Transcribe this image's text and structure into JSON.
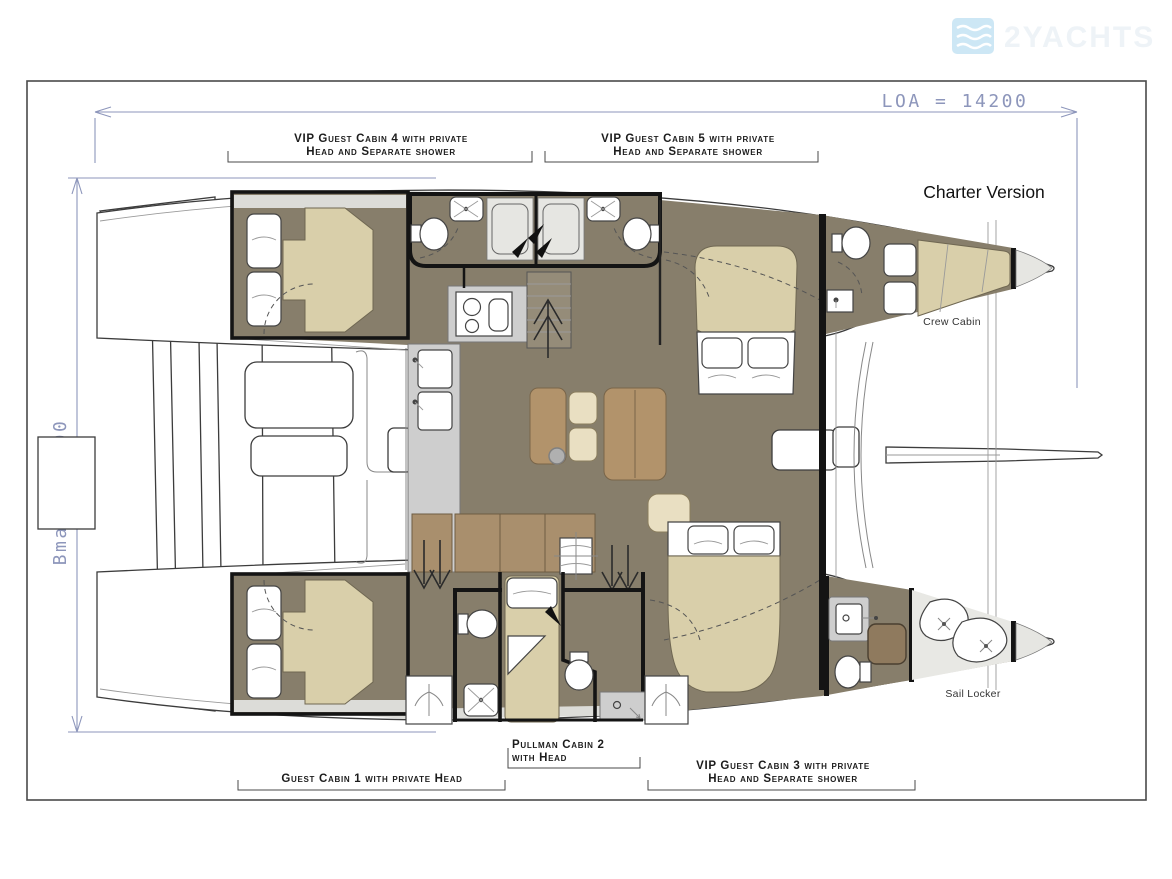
{
  "figure": {
    "kind": "catamaran-deck-plan",
    "version_note": "Charter Version"
  },
  "watermark": {
    "text": "2YACHTS",
    "icon": "waves-logo-icon",
    "icon_color": "#cde7f5"
  },
  "dims": {
    "loa": "LOA = 14200",
    "bmax": "Bmax = 8000",
    "color": "#8d96bb"
  },
  "annotations": {
    "charter": "Charter Version",
    "crew": "Crew Cabin",
    "sail": "Sail Locker"
  },
  "labels": {
    "vip4": {
      "line1": "VIP Guest Cabin 4 with private",
      "line2": "Head and Separate shower"
    },
    "vip5": {
      "line1": "VIP Guest Cabin 5 with private",
      "line2": "Head and Separate shower"
    },
    "pullman2": {
      "line1": "Pullman Cabin 2",
      "line2": "with Head"
    },
    "guest1": {
      "line1": "Guest Cabin 1 with private Head"
    },
    "vip3": {
      "line1": "VIP Guest Cabin 3 with private",
      "line2": "Head and Separate shower"
    }
  },
  "palette": {
    "salon_floor": "#877e6b",
    "wood_furniture": "#b2936b",
    "cream_cushion": "#e9dfc2",
    "bed_tan": "#d9cfaa",
    "counter_gray": "#cecece",
    "deck_gray": "#e6e6e2",
    "wall_black": "#141414",
    "dimension_blue": "#8d96bb"
  }
}
